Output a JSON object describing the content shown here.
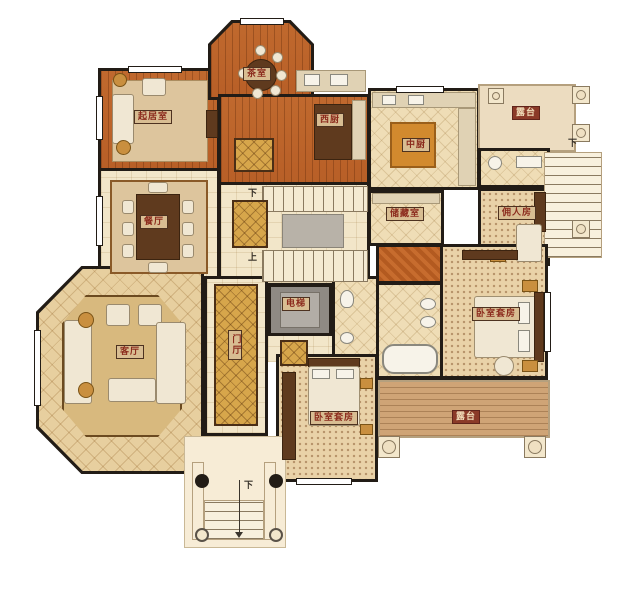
{
  "rooms": {
    "tea_room": {
      "label": "茶室"
    },
    "family_room": {
      "label": "起居室"
    },
    "west_kitchen": {
      "label": "西厨"
    },
    "chinese_kitchen": {
      "label": "中厨"
    },
    "terrace_top": {
      "label": "露台"
    },
    "storage": {
      "label": "储藏室"
    },
    "servant_room": {
      "label": "佣人房"
    },
    "dining_room": {
      "label": "餐厅"
    },
    "living_room": {
      "label": "客厅"
    },
    "foyer": {
      "label": "门厅"
    },
    "elevator": {
      "label": "电梯"
    },
    "master_suite": {
      "label": "卧室套房"
    },
    "bedroom_suite": {
      "label": "卧室套房"
    },
    "terrace_bottom": {
      "label": "露台"
    }
  },
  "stairs": {
    "central_down": "下",
    "central_up": "上",
    "right_down": "下",
    "entry_down": "下"
  },
  "colors": {
    "wall": "#221c16",
    "wood_floor": "#c0692e",
    "tile_floor": "#f2e6c9",
    "carpet": "#e9d2a8",
    "gold_rug": "#d7a64b",
    "deck": "#cfa476",
    "terrace": "#ecdcc0",
    "label_bg": "#d8bd92",
    "label_text": "#8b2a1c",
    "terrace_label_bg": "#8b3a28",
    "terrace_label_text": "#eed9b5"
  }
}
